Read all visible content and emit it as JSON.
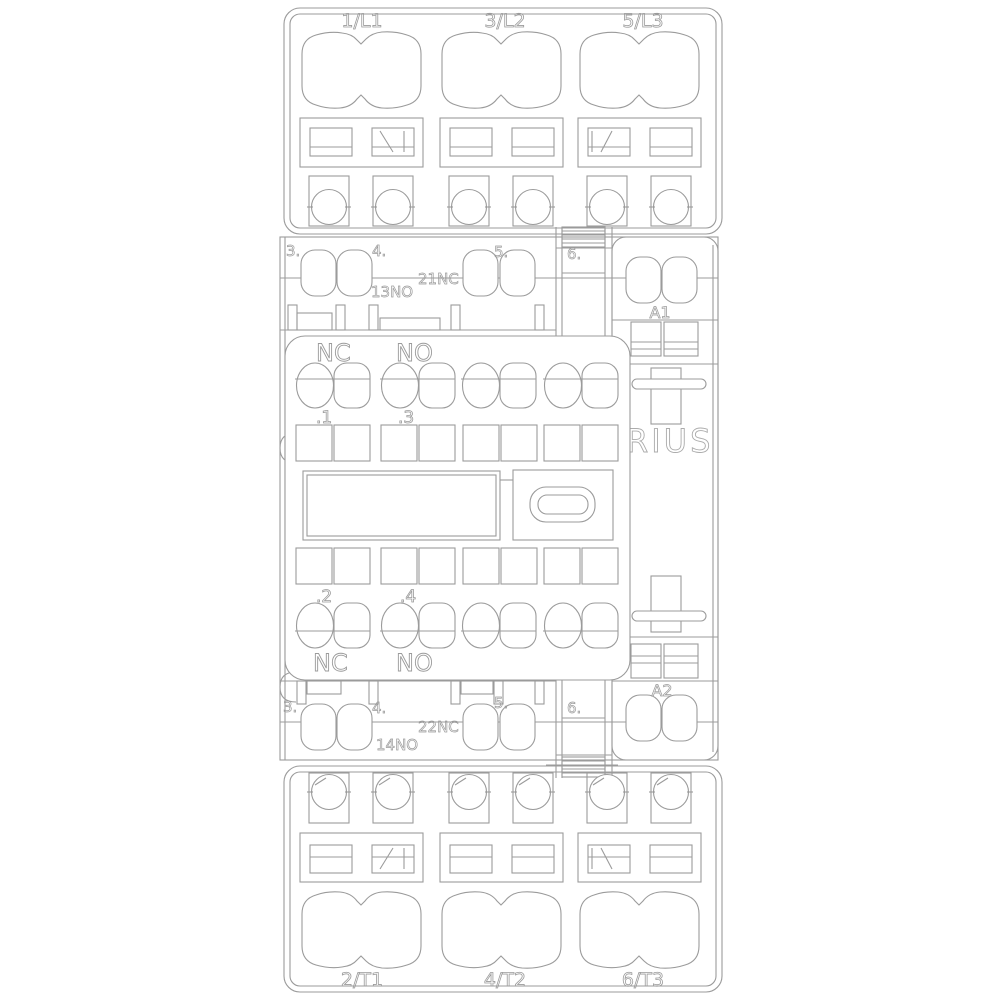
{
  "drawing": {
    "kind": "contactor-front-view-line-drawing",
    "brand": "RIUS",
    "labels": {
      "top_terminals": [
        "1/L1",
        "3/L2",
        "5/L3"
      ],
      "bottom_terminals": [
        "2/T1",
        "4/T2",
        "6/T3"
      ],
      "aux_top": {
        "positions": [
          "3.",
          "4.",
          "5.",
          "6."
        ],
        "no": "13NO",
        "nc": "21NC",
        "coil": "A1"
      },
      "aux_bottom": {
        "positions": [
          "3.",
          "4.",
          "5.",
          "6."
        ],
        "no": "14NO",
        "nc": "22NC",
        "coil": "A2"
      },
      "front_block": {
        "nc_top": "NC",
        "no_top": "NO",
        "nc_bottom": "NC",
        "no_bottom": "NO",
        "pin1": ".1",
        "pin3": ".3",
        "pin2": ".2",
        "pin4": ".4"
      }
    },
    "colors": {
      "line": "#9b9b9b",
      "brand_outline": "#ababab",
      "background": "#ffffff"
    }
  }
}
